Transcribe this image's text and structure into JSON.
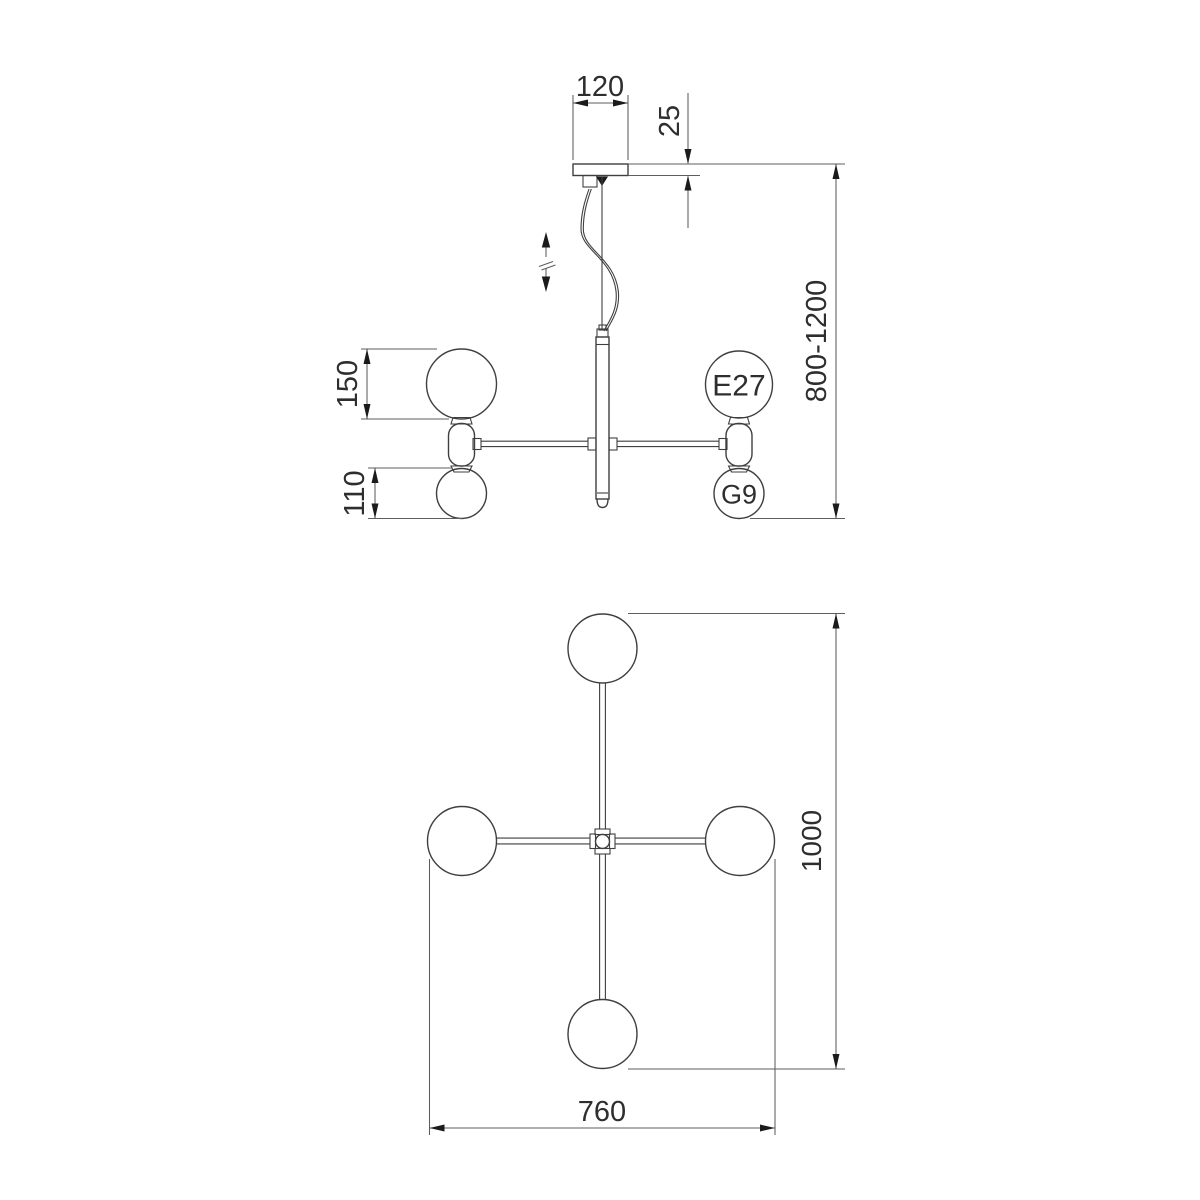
{
  "drawing": {
    "type": "technical dimension drawing",
    "subject": "4-light pendant chandelier (side elevation and plan view)",
    "colors": {
      "line": "#3f3f3f",
      "dimension": "#5e5e5e",
      "arrow": "#1b1b1b",
      "text": "#2e2e2e",
      "background": "#ffffff"
    },
    "side_view": {
      "labels": {
        "canopy_width": "120",
        "canopy_thickness": "25",
        "suspension_height_range": "800-1200",
        "large_globe_diameter": "150",
        "small_globe_diameter": "110",
        "socket_large": "E27",
        "socket_small": "G9"
      },
      "icons": {
        "height_adjust": "up-down-arrows"
      }
    },
    "top_view": {
      "labels": {
        "overall_depth": "1000",
        "overall_width": "760"
      }
    }
  }
}
